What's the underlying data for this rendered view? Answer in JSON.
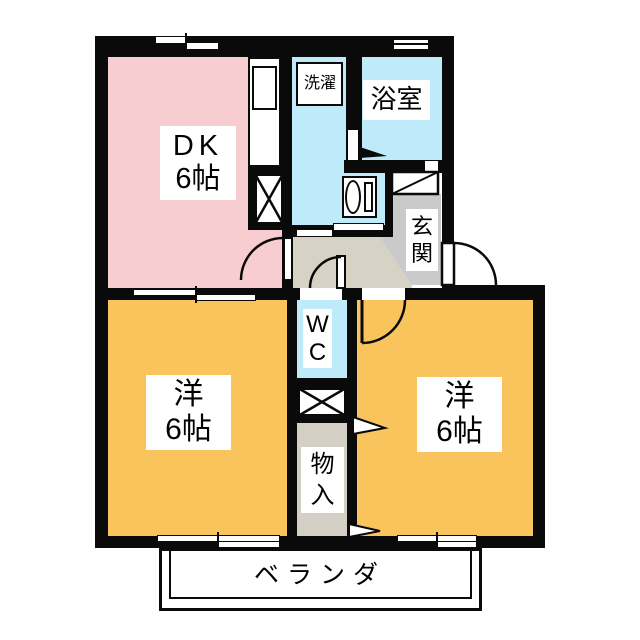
{
  "title": "2DK apartment floor plan",
  "colors": {
    "wall": "#0a0a0a",
    "pink": "#F8CDD2",
    "cyan": "#BEEAFA",
    "orange": "#F9C45C",
    "hall": "#D6D2C6",
    "genkan": "#CACACA",
    "closet": "#D3CFC5"
  },
  "labels": {
    "dk_line1": "DK",
    "dk_line2": "6帖",
    "bathroom": "浴室",
    "laundry": "洗濯",
    "genkan": [
      "玄",
      "関"
    ],
    "wc": [
      "W",
      "C"
    ],
    "closet": [
      "物",
      "入"
    ],
    "room_left_line1": "洋",
    "room_left_line2": "6帖",
    "room_right_line1": "洋",
    "room_right_line2": "6帖",
    "veranda": "ベランダ"
  }
}
